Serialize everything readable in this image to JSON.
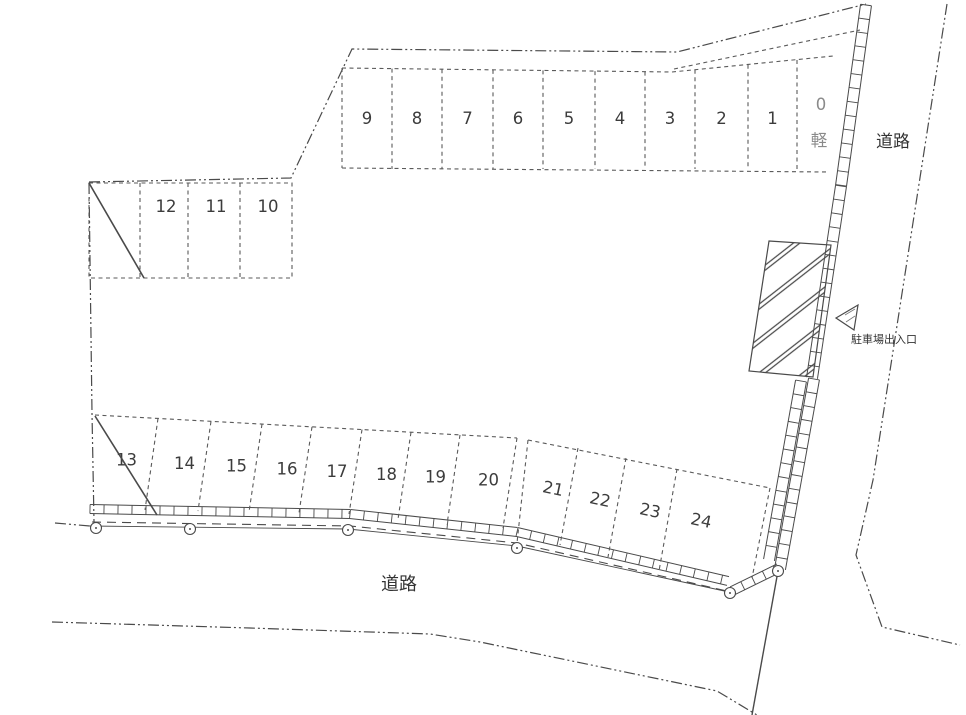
{
  "plan": {
    "road_label_bottom": "道路",
    "road_label_right": "道路",
    "entrance_label": "駐車場出入口",
    "spaces_top": [
      "9",
      "8",
      "7",
      "6",
      "5",
      "4",
      "3",
      "2",
      "1"
    ],
    "space_kei": {
      "number": "0",
      "type_label": "軽"
    },
    "spaces_left": [
      "12",
      "11",
      "10"
    ],
    "spaces_bottom_left": [
      "13",
      "14",
      "15",
      "16",
      "17",
      "18",
      "19",
      "20"
    ],
    "spaces_bottom_right": [
      "21",
      "22",
      "23",
      "24"
    ],
    "colors": {
      "line": "#4a4a4a",
      "number": "#3c3c3c",
      "kei_muted": "#8a8a8a",
      "background": "#ffffff"
    }
  }
}
